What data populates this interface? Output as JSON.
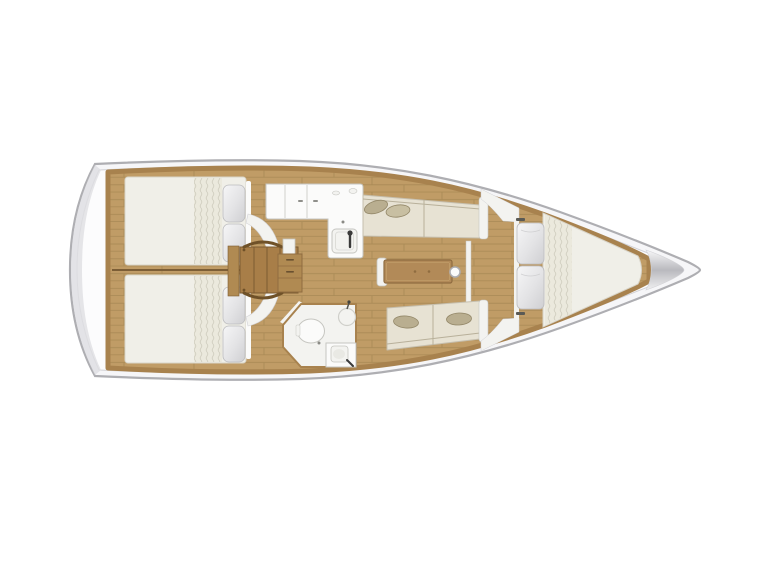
{
  "diagram": {
    "kind": "sailboat-interior-floor-plan",
    "view": "top-down",
    "orientation": "bow-right"
  },
  "legend": {
    "areas": [
      {
        "id": "aft-cabin-port"
      },
      {
        "id": "aft-cabin-starboard"
      },
      {
        "id": "companionway-stairs"
      },
      {
        "id": "galley"
      },
      {
        "id": "head-bathroom"
      },
      {
        "id": "saloon"
      },
      {
        "id": "saloon-table"
      },
      {
        "id": "settee-port"
      },
      {
        "id": "settee-starboard"
      },
      {
        "id": "forward-cabin-vberth"
      },
      {
        "id": "anchor-locker"
      }
    ]
  },
  "colors": {
    "background": "#ffffff",
    "hull_fill": "#f6f6f8",
    "hull_stroke": "#aeaeb2",
    "deck_fill": "#fcfcfd",
    "deck_line": "#d2d2d6",
    "stern_shade": "#dfdfe2",
    "wood": "#c09c66",
    "wood_line": "#a98a55",
    "wood_trim": "#a8824e",
    "wood_dark": "#b08a52",
    "stairs": "#a87e48",
    "stairs_line": "#7d5c32",
    "stairs_rail": "#6f5128",
    "mattress": "#f0efe8",
    "mattress_edge": "#d8d4c8",
    "blanket": "#ebe9dd",
    "blanket_line": "#d3d0c2",
    "pillow_hi": "#f6f6f7",
    "pillow_mid": "#e3e3e5",
    "pillow_lo": "#cfcfd2",
    "pillow_edge": "#bcbcbe",
    "cushion": "#e7e2d3",
    "cushion_edge": "#c6bfae",
    "cushion_shadow": "#b8b09a",
    "throw_pillow": "#b9ae90",
    "throw_pillow2": "#c8bfa2",
    "throw_edge": "#938768",
    "white_fixture": "#fbfbfa",
    "fixture_edge": "#c6c6c1",
    "fixture_soft": "#f3f3f0",
    "table": "#b28a58",
    "table_edge": "#8f6c40",
    "metal_dark": "#3a3a3a",
    "divider_line": "#7c5e36",
    "locker_hi": "#f7f7f8",
    "locker_mid": "#b9b9be",
    "locker_lo": "#f0f0f1"
  }
}
